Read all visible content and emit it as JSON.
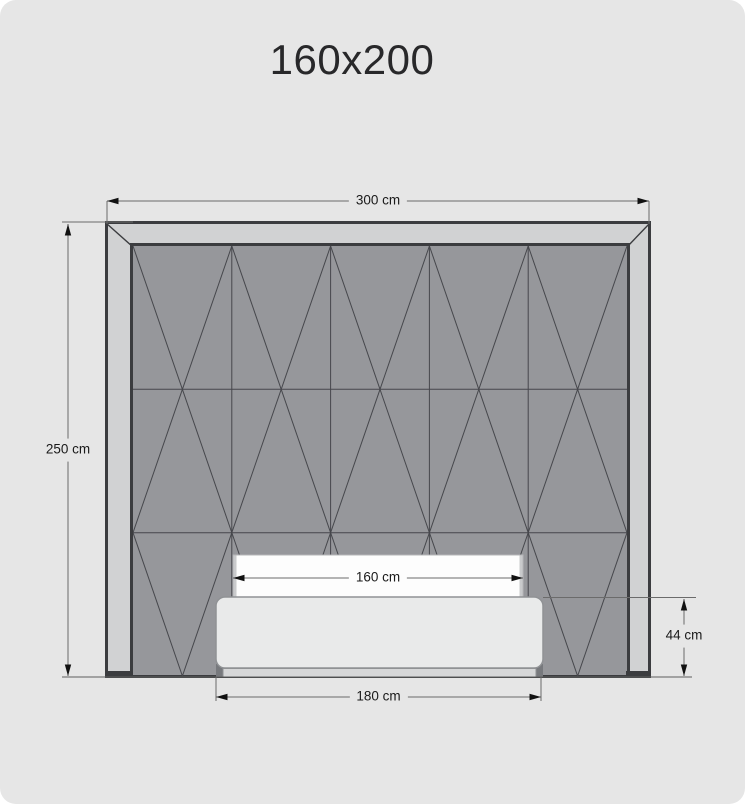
{
  "title": "160x200",
  "dimensions": {
    "overall_width": {
      "label": "300 cm"
    },
    "overall_height": {
      "label": "250 cm"
    },
    "mattress_width": {
      "label": "160 cm"
    },
    "bed_width": {
      "label": "180 cm"
    },
    "bed_height": {
      "label": "44 cm"
    }
  },
  "colors": {
    "background": "#e6e6e6",
    "frame_fill": "#d1d2d3",
    "frame_border": "#3b3c3f",
    "panel_fill": "#96979b",
    "pattern_line": "#46474c",
    "mattress_fill": "#fdfdfd",
    "bed_frame_fill": "#e9eaea",
    "plinth_fill": "#d6d7d8",
    "foot_fill": "#77797d",
    "dimension_line": "#6b6b6b",
    "arrow": "#111111",
    "label_text": "#1a1a1a"
  }
}
